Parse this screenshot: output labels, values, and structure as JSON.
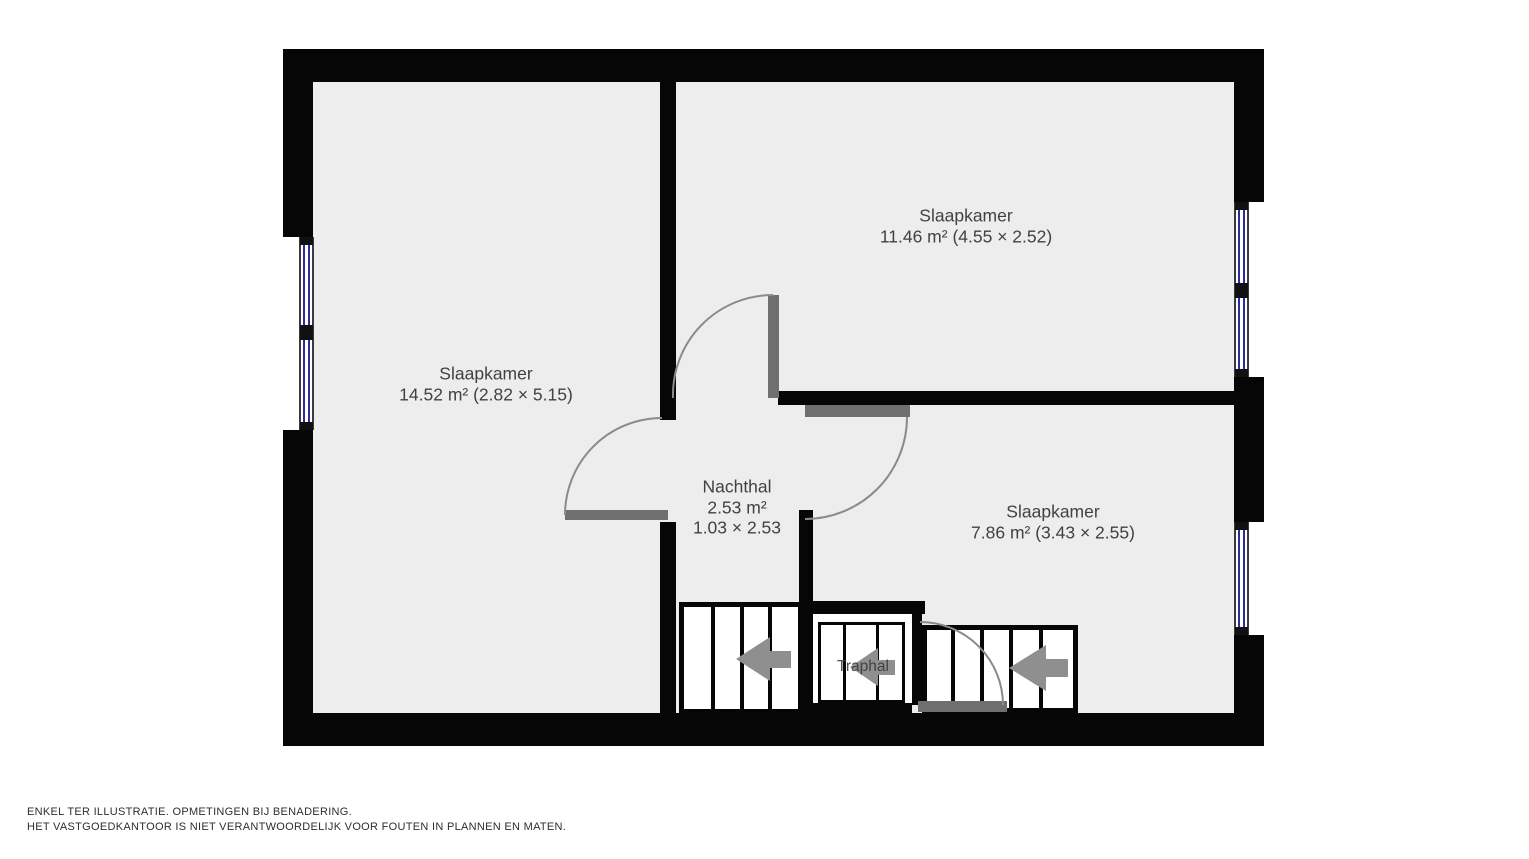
{
  "floorplan": {
    "rooms": {
      "bedroom_left": {
        "name": "Slaapkamer",
        "details": "14.52 m² (2.82 × 5.15)"
      },
      "bedroom_top_right": {
        "name": "Slaapkamer",
        "details": "11.46 m² (4.55 × 2.52)"
      },
      "bedroom_bottom_right": {
        "name": "Slaapkamer",
        "details": "7.86 m² (3.43 × 2.55)"
      },
      "night_hall": {
        "name": "Nachthal",
        "area": "2.53 m²",
        "dimensions": "1.03 × 2.53"
      },
      "stair_hall": {
        "name": "Traphal"
      }
    },
    "icons": {
      "stair_direction": "left-arrow"
    },
    "colors": {
      "wall": "#060606",
      "floor": "#ededed",
      "door_leaf": "#6f6f6f",
      "stair_arrow": "#8f8f8f",
      "window_glass": "#2b2b9e",
      "label_text": "#3f4245"
    },
    "disclaimer": {
      "line1": "ENKEL TER ILLUSTRATIE. OPMETINGEN BIJ BENADERING.",
      "line2": "HET VASTGOEDKANTOOR IS NIET VERANTWOORDELIJK VOOR FOUTEN IN PLANNEN EN MATEN."
    }
  }
}
